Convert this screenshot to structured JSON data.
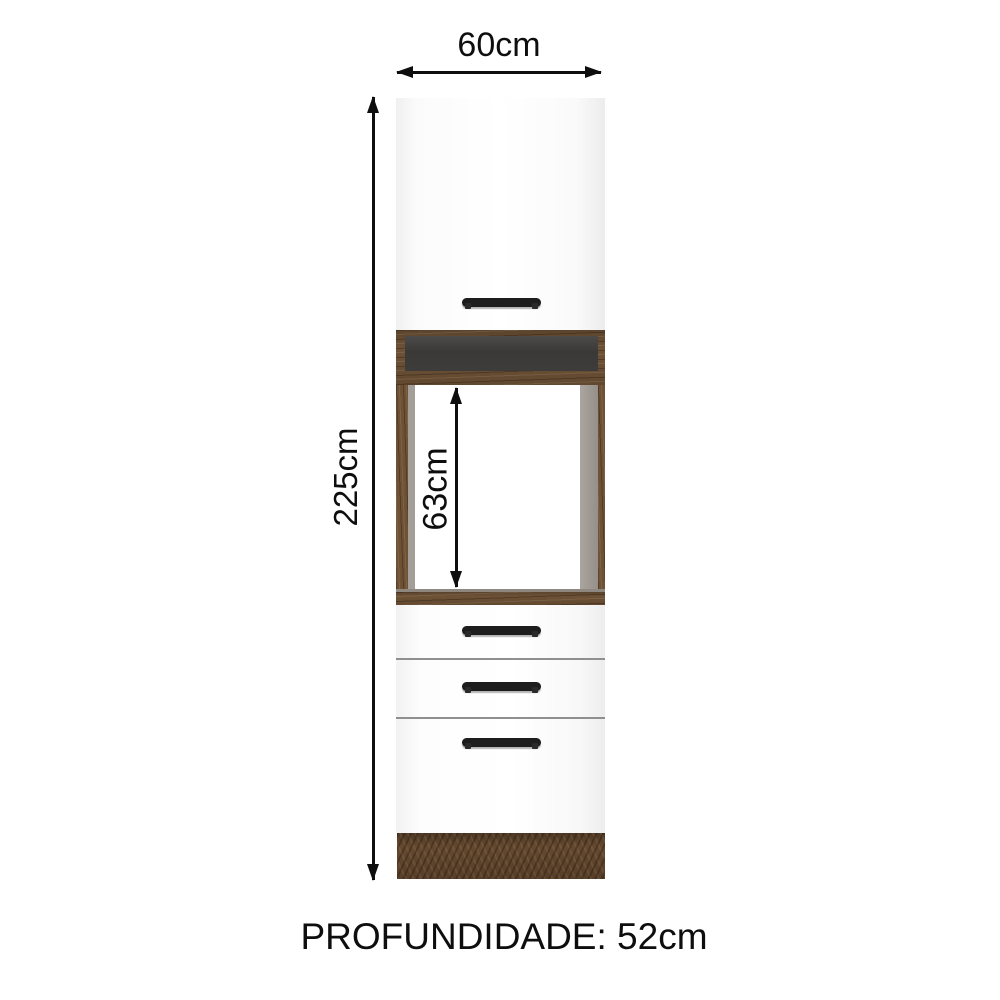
{
  "labels": {
    "width": "60cm",
    "height": "225cm",
    "niche_height": "63cm",
    "depth": "PROFUNDIDADE: 52cm"
  },
  "colors": {
    "background": "#ffffff",
    "wood_brown": "#6e5236",
    "plinth_brown": "#65492f",
    "panel_white": "#fbfbfb",
    "recess_dark": "#3b3a39",
    "inner_wall_gray": "#a49e98",
    "handle_black": "#1d1d1d",
    "dimension_black": "#0e0e0e"
  },
  "cabinet": {
    "parts": [
      "upper-door",
      "open-recess",
      "oven-niche",
      "drawer-1",
      "drawer-2",
      "drawer-3",
      "plinth"
    ],
    "handle_count": 4
  }
}
